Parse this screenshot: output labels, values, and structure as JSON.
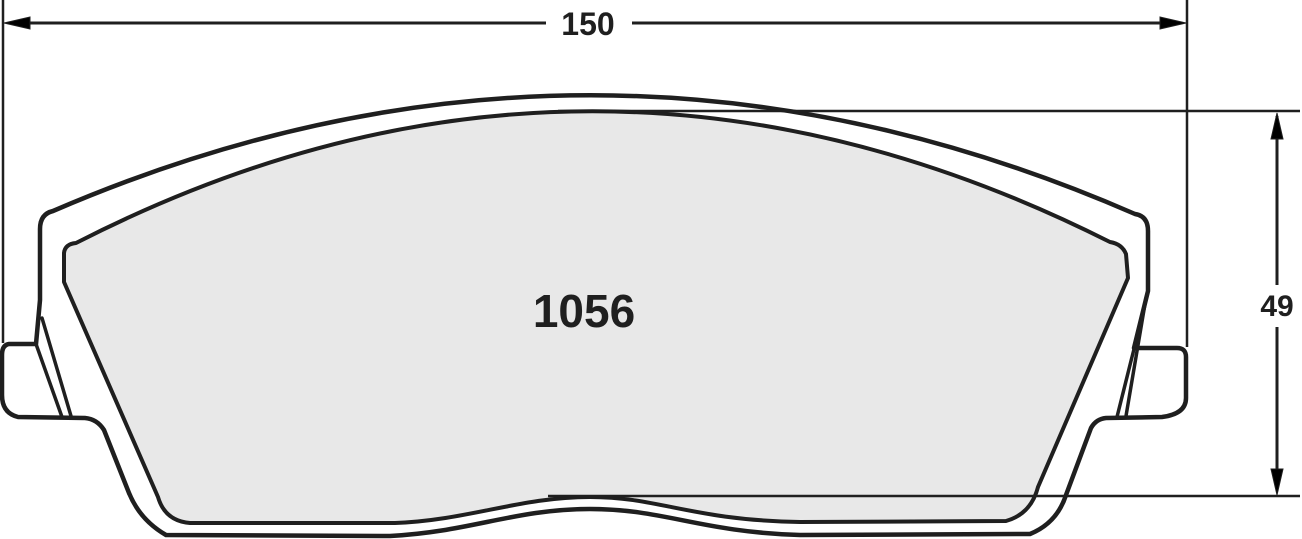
{
  "diagram": {
    "part_number": "1056",
    "dimensions": {
      "width": "150",
      "height": "49"
    },
    "colors": {
      "line": "#1f1f1f",
      "friction_fill": "#e8e8e8",
      "background": "#ffffff"
    }
  }
}
